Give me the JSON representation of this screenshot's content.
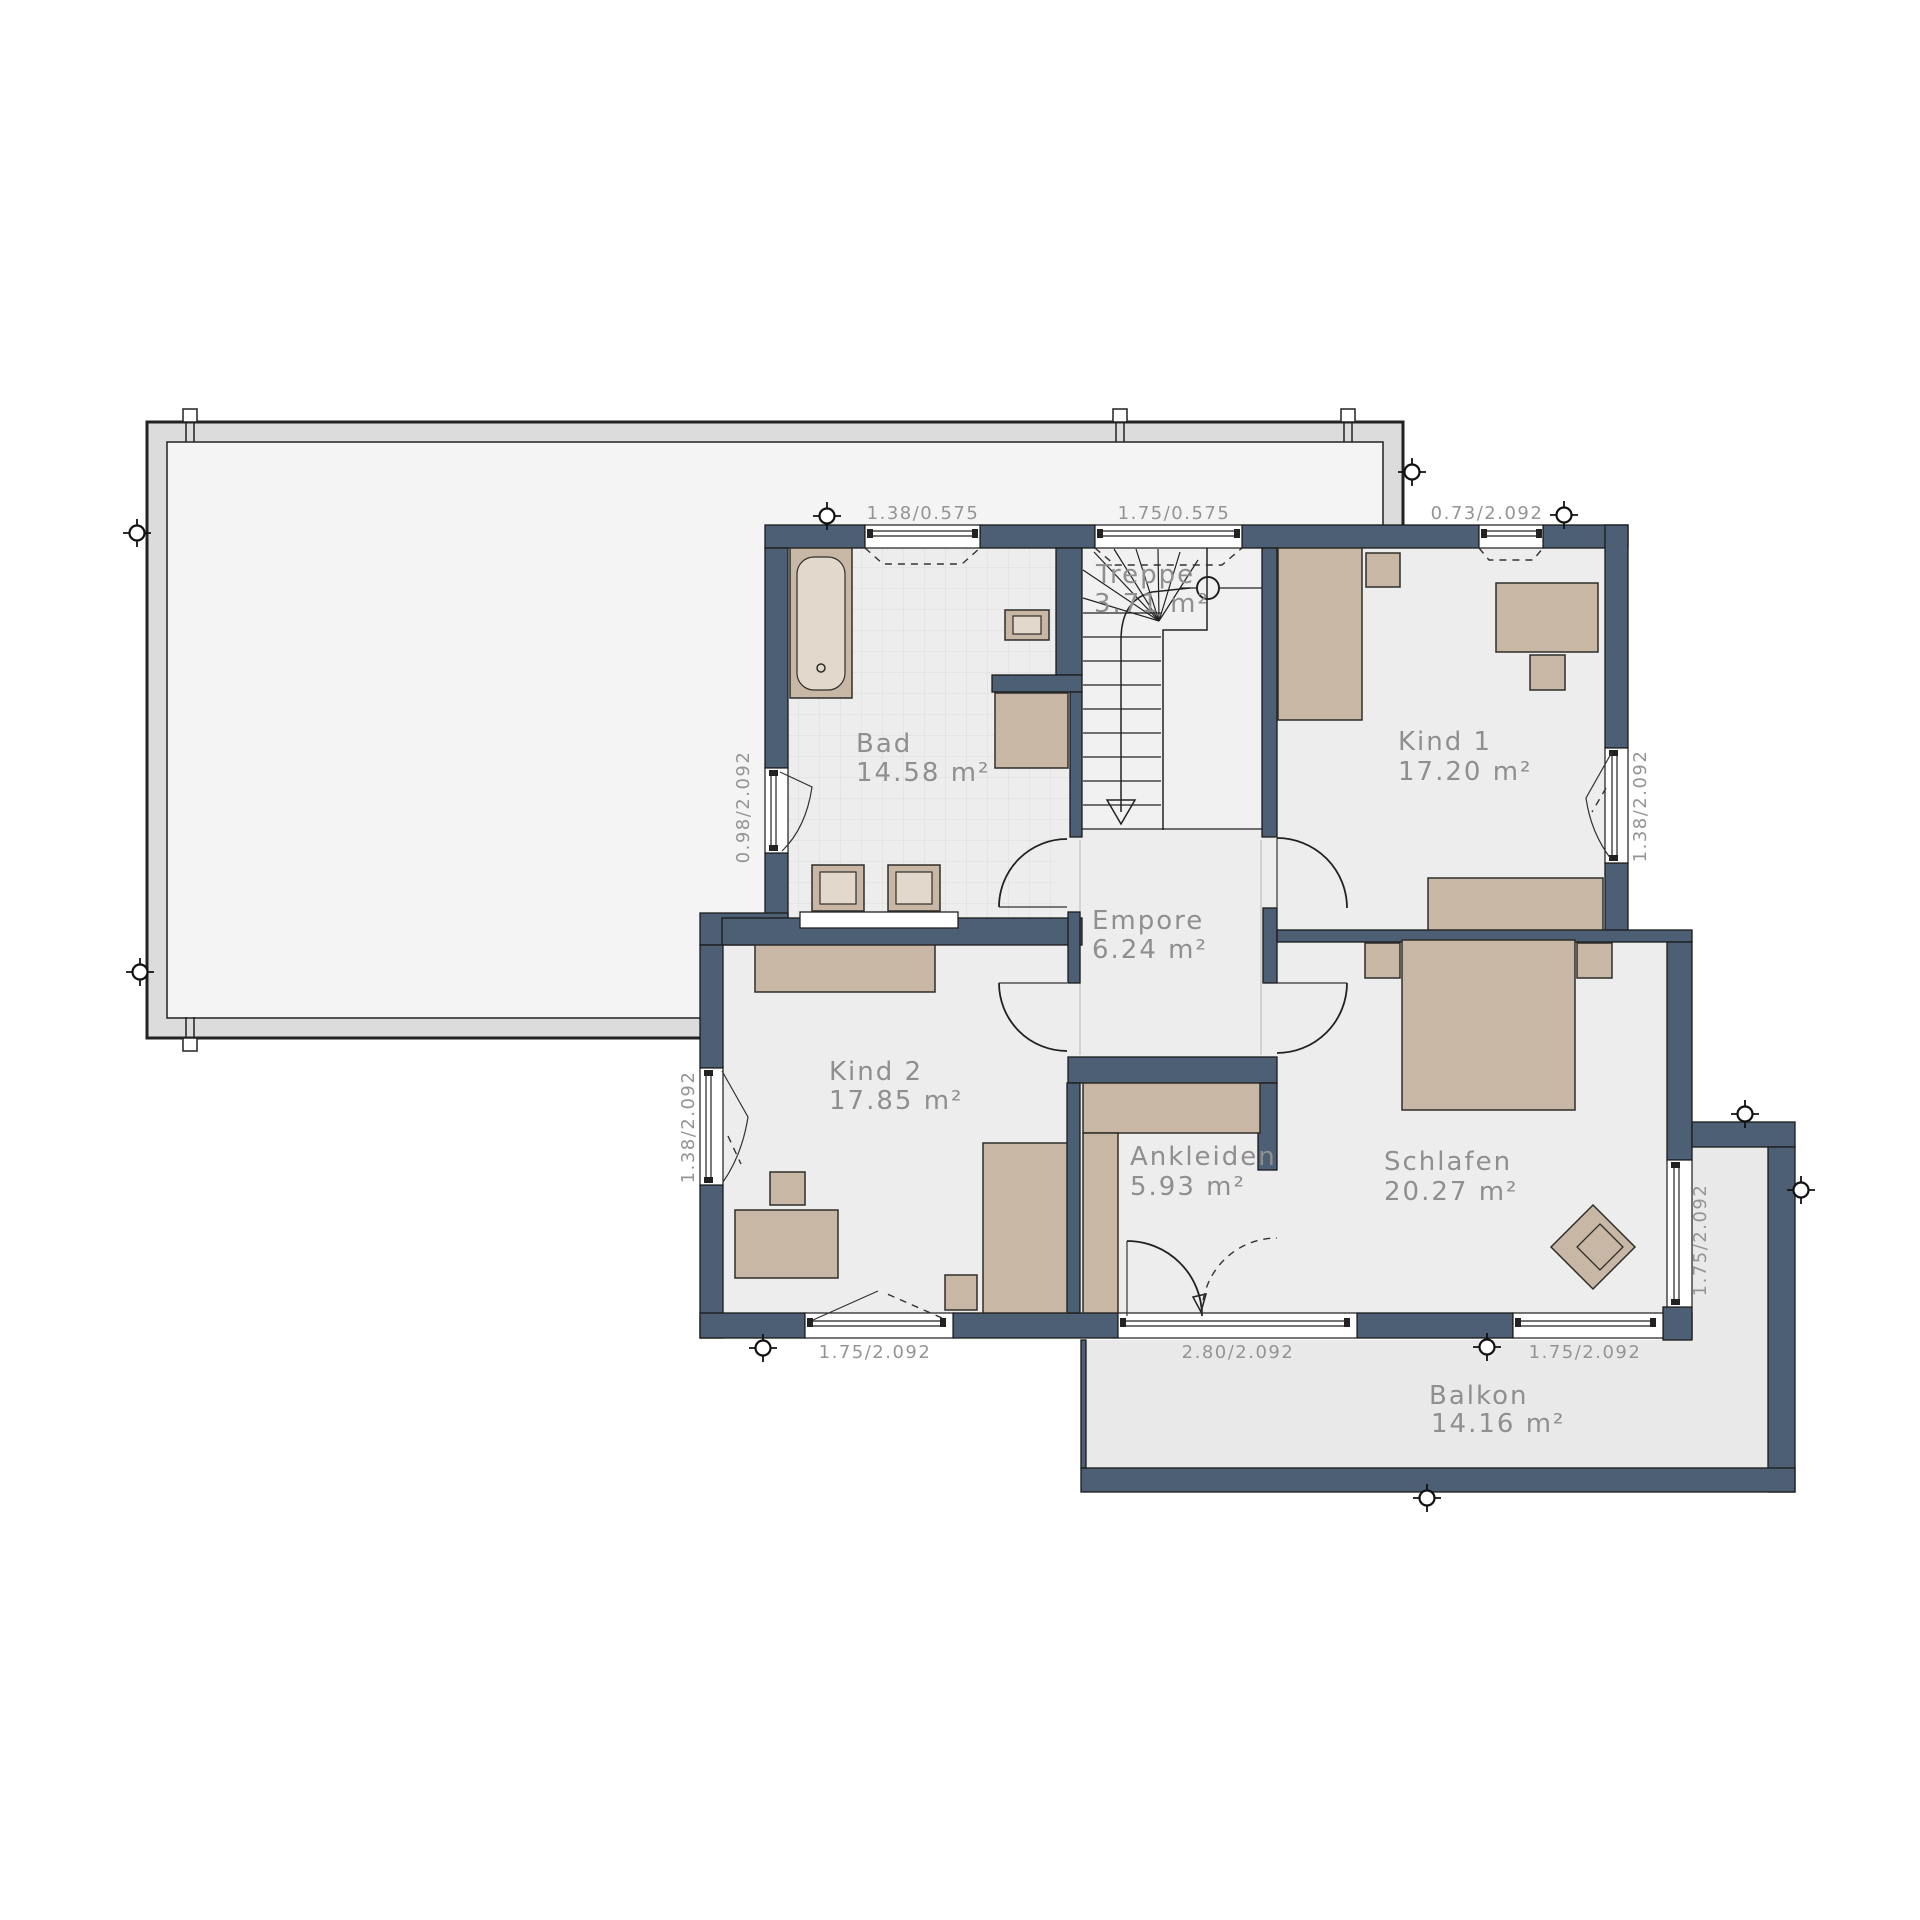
{
  "plan": {
    "type": "floorplan-upper-storey",
    "rooms": [
      {
        "id": "treppe",
        "name": "Treppe",
        "area": "3.71 m²"
      },
      {
        "id": "bad",
        "name": "Bad",
        "area": "14.58 m²"
      },
      {
        "id": "kind1",
        "name": "Kind 1",
        "area": "17.20 m²"
      },
      {
        "id": "empore",
        "name": "Empore",
        "area": "6.24 m²"
      },
      {
        "id": "kind2",
        "name": "Kind 2",
        "area": "17.85 m²"
      },
      {
        "id": "ankleiden",
        "name": "Ankleiden",
        "area": "5.93 m²"
      },
      {
        "id": "schlafen",
        "name": "Schlafen",
        "area": "20.27 m²"
      },
      {
        "id": "balkon",
        "name": "Balkon",
        "area": "14.16 m²"
      }
    ],
    "dimensions": {
      "top": [
        "1.38/0.575",
        "1.75/0.575",
        "0.73/2.092"
      ],
      "bottom": [
        "1.75/2.092",
        "2.80/2.092",
        "1.75/2.092"
      ],
      "left": [
        "0.98/2.092",
        "1.38/2.092"
      ],
      "right": [
        "1.38/2.092",
        "1.75/2.092"
      ]
    },
    "colors": {
      "wall": "#4d5f74",
      "floor": "#ededed",
      "balcony_floor": "#e9e9e9",
      "furniture": "#c8b7a5",
      "ground_outline_band": "#dcdcdc",
      "ground_outline_fill": "#f4f4f4",
      "label_text": "#8f8f8f"
    }
  }
}
